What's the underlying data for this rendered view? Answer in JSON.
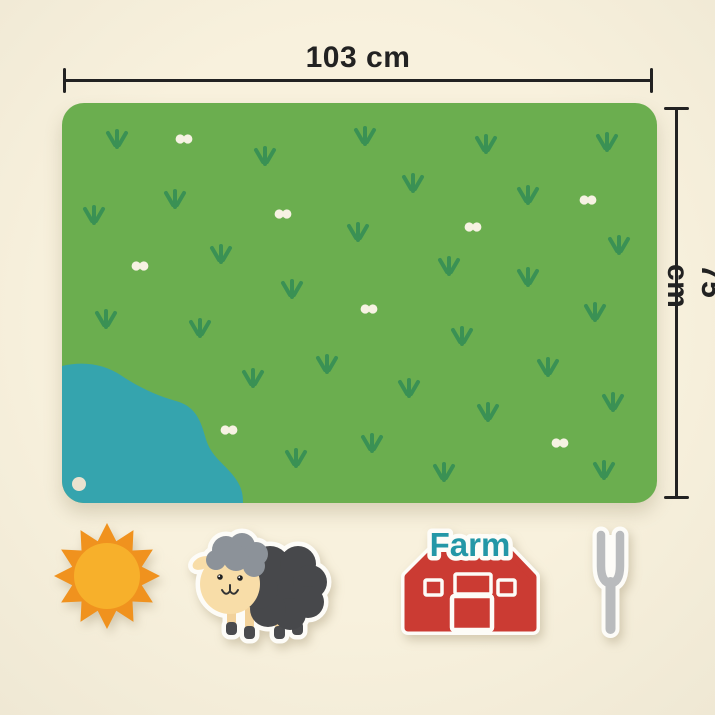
{
  "dimensions": {
    "width_label": "103 cm",
    "height_label": "75 cm"
  },
  "mat": {
    "grass_positions": [
      [
        55,
        37
      ],
      [
        203,
        54
      ],
      [
        303,
        34
      ],
      [
        424,
        42
      ],
      [
        545,
        40
      ],
      [
        113,
        97
      ],
      [
        351,
        81
      ],
      [
        466,
        93
      ],
      [
        32,
        113
      ],
      [
        296,
        130
      ],
      [
        557,
        143
      ],
      [
        159,
        152
      ],
      [
        387,
        164
      ],
      [
        466,
        175
      ],
      [
        230,
        187
      ],
      [
        533,
        210
      ],
      [
        44,
        217
      ],
      [
        138,
        226
      ],
      [
        400,
        234
      ],
      [
        265,
        262
      ],
      [
        486,
        265
      ],
      [
        191,
        276
      ],
      [
        347,
        286
      ],
      [
        551,
        300
      ],
      [
        426,
        310
      ],
      [
        310,
        341
      ],
      [
        234,
        356
      ],
      [
        382,
        370
      ],
      [
        542,
        368
      ]
    ],
    "dot_positions": [
      [
        122,
        36
      ],
      [
        526,
        97
      ],
      [
        221,
        111
      ],
      [
        411,
        124
      ],
      [
        78,
        163
      ],
      [
        307,
        206
      ],
      [
        167,
        327
      ],
      [
        498,
        340
      ]
    ]
  },
  "stickers": {
    "sun": {
      "name": "sun"
    },
    "sheep": {
      "name": "sheep"
    },
    "barn": {
      "name": "barn",
      "label": "Farm"
    },
    "fork": {
      "name": "fork"
    }
  },
  "theme": {
    "bg": "#f8f1dd",
    "bg_edge": "#efe8d4",
    "dim": "#222222",
    "mat_green": "#6bae4f",
    "grass_green": "#3a9154",
    "pond_teal": "#35a4ae",
    "dot_cream": "#f7f2e3",
    "button_cream": "#eae2cf",
    "sun_ray": "#f0921e",
    "sun_disc": "#f7b02b",
    "sheep_body": "#47484b",
    "sheep_fleece": "#8c9299",
    "sheep_face": "#f8dda8",
    "sheep_leg": "#f2d29b",
    "sheep_hoof": "#4a4b4e",
    "sheep_line": "#333333",
    "barn_red": "#cb3b33",
    "farm_teal": "#2397a7",
    "fork_gray": "#b9bbbd",
    "sticker_white": "#fdfcf8"
  }
}
